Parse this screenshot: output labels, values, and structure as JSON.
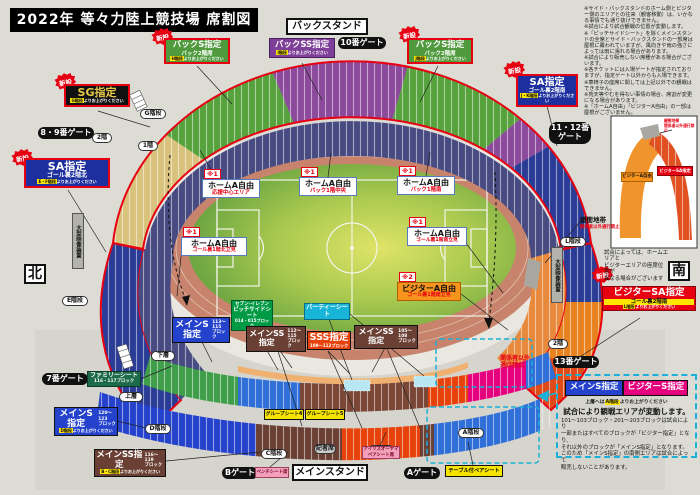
{
  "title": "2022年 等々力陸上競技場 席割図",
  "compass": {
    "north": "北",
    "south": "南"
  },
  "stand_names": {
    "back": "バックスタンド",
    "main": "メインスタンド"
  },
  "badge_new": "新設",
  "gates": {
    "g7": "7番ゲート",
    "g8_9": "8・9番ゲート",
    "g10": "10番ゲート",
    "g11_12": "11・12番\nゲート",
    "g13": "13番ゲート",
    "a": "Aゲート",
    "b": "Bゲート"
  },
  "pills": {
    "f2_left": "2階",
    "f1_left": "1階",
    "f2_right": "2階",
    "lower": "下層",
    "upper": "上層",
    "stairs_a": "A階段",
    "stairs_b": "B階段",
    "stairs_c": "C階段",
    "stairs_d": "D階段",
    "stairs_e": "E階段",
    "stairs_g": "G階段",
    "stairs_l": "L階段",
    "press": "記者席"
  },
  "sections": {
    "back_s_left": {
      "title": "バックS指定",
      "sub": "バック2階席",
      "note_key": "H階段",
      "note_rest": "よりお上がりください"
    },
    "back_ss": {
      "title": "バックSS指定",
      "note_key": "I階段",
      "note_rest": "よりお上がりください"
    },
    "back_s_right": {
      "title": "バックS指定",
      "sub": "バック2階席",
      "note_key": "J階段",
      "note_rest": "よりお上がりください"
    },
    "sg": {
      "title": "SG指定",
      "note_key": "G階段",
      "note_rest": "よりお上がりください"
    },
    "sa_left": {
      "title": "SA指定",
      "sub": "ゴール裏2階北",
      "note_key": "E・F階段",
      "note_rest": "よりお上がりください"
    },
    "sa_right": {
      "title": "SA指定",
      "sub": "ゴール裏2階南",
      "note_key": "J・K階段",
      "note_rest": "よりお上がりください"
    },
    "visitor_sa": {
      "title": "ビジターSA指定",
      "sub": "ゴール裏2階南",
      "note_key": "L階段",
      "note_rest": "よりお上がりください"
    },
    "main_s_center": {
      "title": "メインS指定",
      "blocks": "113〜115\nブロック"
    },
    "main_ss_left": {
      "title": "メインSS指定",
      "blocks": "112〜115\nブロック"
    },
    "sss": {
      "title": "SSS指定",
      "blocks": "109〜112ブロック"
    },
    "main_ss_right": {
      "title": "メインSS指定",
      "blocks": "105〜108\nブロック"
    },
    "main_s_lower_left": {
      "title": "メインS指定",
      "blocks": "120〜123\nブロック",
      "note_key": "D階段",
      "note_rest": "よりお上がりください"
    },
    "main_ss_bottom": {
      "title": "メインSS指定",
      "blocks": "116〜119\nブロック",
      "note_key": "B・C階段",
      "note_rest": "よりお上がりください"
    },
    "family": {
      "title": "ファミリーシート",
      "blocks": "116・117ブロック"
    },
    "pitchside": {
      "brand": "セブン-イレブン",
      "title": "ピッチサイドシート",
      "blocks": "014・015ブロック"
    },
    "party": {
      "title": "パーティーシート"
    },
    "group4": {
      "title": "グループシート4"
    },
    "group5": {
      "title": "グループシート5"
    },
    "table_pair": {
      "title": "テーブル付ペアシート"
    },
    "pink_pair": {
      "title": "アイリスオーヤマ\nペアシート席"
    },
    "bench": {
      "title": "ベンチシート席"
    }
  },
  "field_labels": {
    "m1": "※1",
    "m2": "※2",
    "ha1": {
      "title": "ホームA自由",
      "sub": "応援中心エリア"
    },
    "ha2": {
      "title": "ホームA自由",
      "sub": "バック1階中央"
    },
    "ha3": {
      "title": "ホームA自由",
      "sub": "バック1階南"
    },
    "ha4": {
      "title": "ホームA自由",
      "sub": "ゴール裏1階北立見"
    },
    "ha5": {
      "title": "ホームA自由",
      "sub": "ゴール裏1階南立見"
    },
    "va": {
      "title": "ビジターA自由",
      "sub": "ゴール裏1階南立見"
    }
  },
  "buffer_zone": {
    "title": "緩衝地帯",
    "sub": "関係者以外通行禁止"
  },
  "no_entry": "関係者以外\n通行禁止",
  "screen": "大型映像装置",
  "variable_box": {
    "main_s": "メインS指定",
    "visitor_s": "ビジターS指定",
    "stairs_note_pre": "上層へは",
    "stairs_note_key": "A階段",
    "stairs_note_rest": "よりお上がりください",
    "headline": "試合により観戦エリアが変動します。",
    "body": "101〜103ブロック・201〜203ブロックは試合により\n一部またはすべてのブロックが「ビジター指定」となり、\nそれ以外のブロックが「メインS指定」となります。\nこのため「メインS指定」の南側エリアは試合によって\n販売しないことがあります。"
  },
  "inset": {
    "visitor_a": "ビジターA自由",
    "visitor_sa": "ビジターSA指定",
    "buffer": "緩衝地帯\n関係者以外通行禁止",
    "caption": "試合によっては、ホームエリアと\nビジターエリアの座席位置が\n異なる場合がございます"
  },
  "fine_print": "※サイド・バックスタンドのホーム側とビジター側のエリアとの往来（観客移動）は、いかなる事情でも通り抜けできません。\n※試合により試合観戦の位置が変動します。\n※「ピッチサイドシート」を除くメインスタンドの全席とサイド・バックスタンドの一部席は屋根に覆われていますが、風向きや雨の強さによっては雨に濡れる場合があります。\n※試合により販売しない席種がある場合がございます。\n※各チケットには入場ゲートが指定されておりますが、指定ゲート以外からも入場できます。\n※車椅子の座席に関しては上記以外での観戦はできません。\n※荒天等やむを得ない事情の場合、席割が変更になる場合があります。\n※「ホームA自由」「ビジターA自由」の一部は屋根がございません。",
  "colors": {
    "accent_red": "#e60012",
    "visitor_pink": "#e5007e",
    "main_blue": "#2442cc",
    "cyan": "#1ab0d8"
  }
}
